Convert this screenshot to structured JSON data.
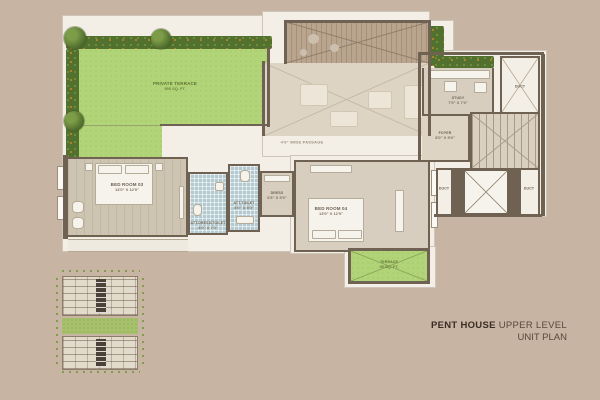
{
  "plan": {
    "passage_label": "4'6\" WIDE PASSAGE",
    "rooms": {
      "private_terrace": {
        "name": "PRIVATE TERRACE",
        "size": "950 SQ. FT."
      },
      "bed_room_03": {
        "name": "BED ROOM 03",
        "size": "13'0\" X 12'0\""
      },
      "att_toilet": {
        "name": "ATT.TOILET",
        "size": "8'0\" X 5'0\""
      },
      "att_dress_toilet": {
        "name": "ATT.DRESS/TOILET",
        "size": "8'0\" X 7'0\""
      },
      "dress": {
        "name": "DRESS",
        "size": "6'6\" X 5'0\""
      },
      "bed_room_04": {
        "name": "BED ROOM 04",
        "size": "13'0\" X 12'0\""
      },
      "study": {
        "name": "STUDY",
        "size": "7'9\" X 7'0\""
      },
      "foyer": {
        "name": "FOYER",
        "size": "8'0\" X 5'0\""
      },
      "terrace": {
        "name": "TERRACE",
        "size": "95 SQ. FT."
      }
    },
    "ducts": {
      "top": "DUCT",
      "left": "DUCT",
      "right": "DUCT"
    }
  },
  "titleblock": {
    "project": "PENT HOUSE",
    "level": "UPPER LEVEL",
    "line2": "UNIT PLAN"
  },
  "colors": {
    "background": "#c8b4a2",
    "wall": "#6f6253",
    "terrace_green": "#b2d478",
    "hedge_green": "#52702e",
    "toilet_tile": "#b3cad0",
    "deck_wood": "#b9a48e",
    "title_dark": "#372d24"
  }
}
